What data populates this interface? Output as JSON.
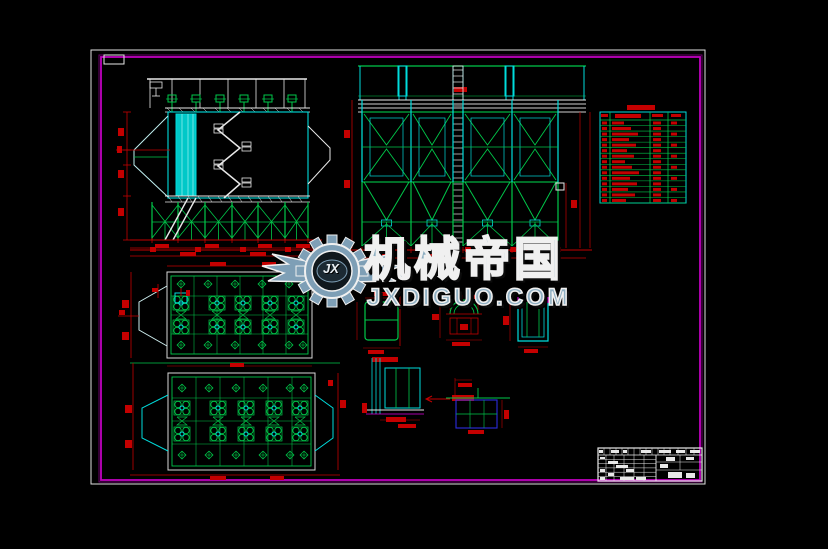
{
  "canvas": {
    "background": "#000000",
    "paper_border_color": "#e0e0e0",
    "frame_color": "#c000c0",
    "frame_shadow_color": "#6a006a"
  },
  "palette": {
    "cad_cyan": "#00dcdc",
    "cad_cyan_fill": "#00c8c8",
    "cad_green": "#00c84a",
    "cad_red": "#c40000",
    "cad_white": "#e8e8e8",
    "cad_gray": "#bdbdbd",
    "cad_magenta": "#e000e0",
    "cad_blue": "#2b2bdf"
  },
  "watermark": {
    "brand": "机械帝国",
    "domain": "JXDIGUO.COM",
    "monogram": "JX",
    "text_color": "#8fafc2",
    "outline_color": "#f0f0f0"
  },
  "drawing": {
    "views": [
      {
        "id": "side-elevation-view"
      },
      {
        "id": "front-elevation-view"
      },
      {
        "id": "parts-list-table"
      },
      {
        "id": "plan-view-upper"
      },
      {
        "id": "plan-view-lower"
      },
      {
        "id": "detail-views"
      },
      {
        "id": "title-block"
      }
    ],
    "parts_table": {
      "rows": 16,
      "columns": 4,
      "text_color": "#c40000",
      "legible": false
    },
    "title_block": {
      "legible": false
    }
  }
}
